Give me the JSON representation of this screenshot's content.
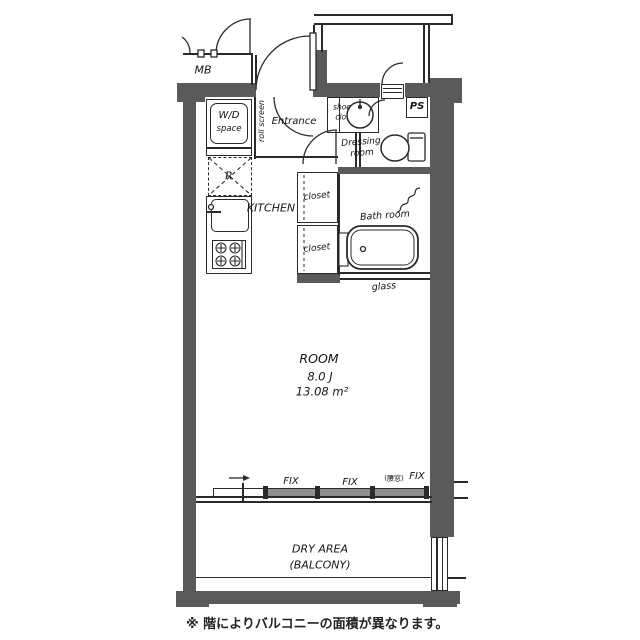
{
  "palette": {
    "wall": "#5a5a5a",
    "line": "#2a2a2a",
    "window_fill": "#8f8f8f",
    "background": "#ffffff"
  },
  "floorplan": {
    "exterior": {
      "meter_box": "MB",
      "pipe_shaft": "PS"
    },
    "entrance": {
      "label": "Entrance",
      "shoe_closet_line1": "shoe",
      "shoe_closet_line2": "clo.",
      "roll_screen": "roll screen"
    },
    "laundry": {
      "line1": "W/D",
      "line2": "space"
    },
    "kitchen": {
      "label": "KITCHEN",
      "refrigerator": "R"
    },
    "storage": {
      "closet_upper": "closet",
      "closet_lower": "closet"
    },
    "sanitary": {
      "dressing_line1": "Dressing",
      "dressing_line2": "room",
      "bath": "Bath room",
      "glass": "glass"
    },
    "main_room": {
      "name": "ROOM",
      "size_tatami": "8.0 J",
      "size_m2": "13.08 m²"
    },
    "windows": {
      "fix_left": "FIX",
      "fix_center": "FIX",
      "fix_right_prefix": "(腰窓)",
      "fix_right": "FIX"
    },
    "balcony": {
      "line1": "DRY AREA",
      "line2": "(BALCONY)"
    },
    "footnote": "※ 階によりバルコニーの面積が異なります。"
  }
}
